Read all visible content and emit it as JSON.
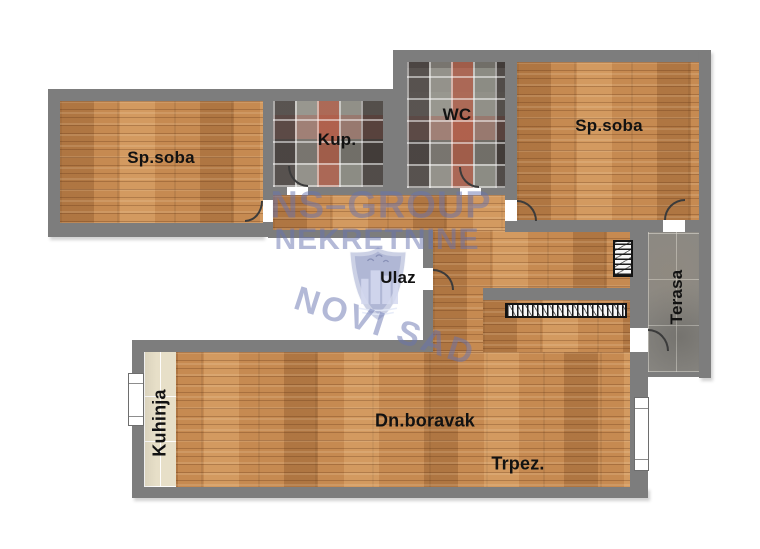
{
  "meta": {
    "type": "apartment-floor-plan"
  },
  "rooms": {
    "bedroom_left": "Sp.soba",
    "bathroom": "Kup.",
    "wc": "WC",
    "bedroom_right": "Sp.soba",
    "entrance": "Ulaz",
    "kitchen": "Kuhinja",
    "living_room": "Dn.boravak",
    "dining": "Trpez.",
    "terrace": "Terasa"
  },
  "watermark": {
    "agency_line1": "NS–GROUP",
    "agency_line2": "NEKRETNINE",
    "city": "NOVI SAD"
  },
  "colors": {
    "wall": "#7d7d7d",
    "wood_floor": "#c68a51",
    "bath_tile": "#95948e",
    "kitchen_tile": "#e7dfc8",
    "terrace_floor": "#8b8984",
    "watermark_blue": "rgba(104,116,176,0.5)"
  }
}
